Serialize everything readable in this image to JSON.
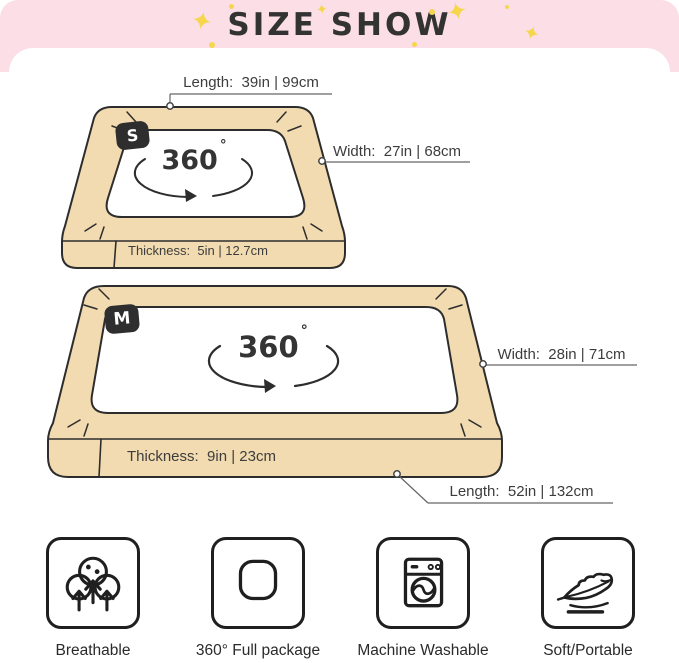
{
  "header": {
    "title": "SIZE SHOW",
    "stars": [
      "✦",
      "✦",
      "✦",
      "✦"
    ]
  },
  "beds": [
    {
      "badge": "S",
      "rotate": "360",
      "degree": "°",
      "length_label": "Length:  39in | 99cm",
      "width_label": "Width:  27in | 68cm",
      "thickness_label": "Thickness:  5in | 12.7cm"
    },
    {
      "badge": "M",
      "rotate": "360",
      "degree": "°",
      "width_label": "Width:  28in | 71cm",
      "thickness_label": "Thickness:  9in | 23cm",
      "length_label": "Length:  52in | 132cm"
    }
  ],
  "features": [
    {
      "icon": "breathable-icon",
      "label": "Breathable"
    },
    {
      "icon": "full-package-icon",
      "label": "360° Full package"
    },
    {
      "icon": "machine-washable-icon",
      "label": "Machine Washable"
    },
    {
      "icon": "soft-portable-icon",
      "label": "Soft/Portable"
    }
  ],
  "colors": {
    "banner_pink": "#fbdee6",
    "bed_tan": "#f2dbb0",
    "outline_dark": "#2d2d2d",
    "star_yellow": "#f6d64d",
    "text": "#3d3d3d"
  }
}
